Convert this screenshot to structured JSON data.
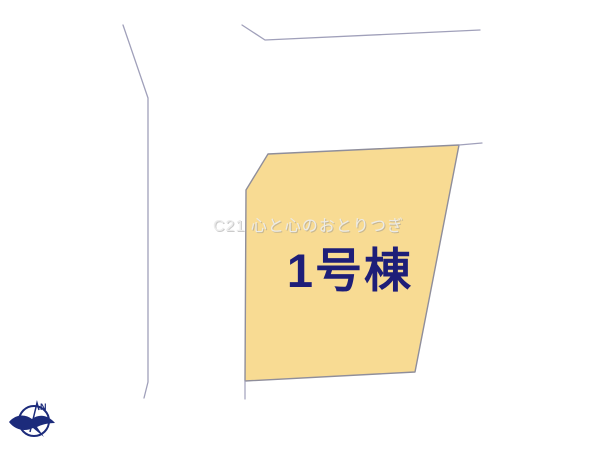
{
  "plan": {
    "parcel": {
      "label": "1号棟"
    },
    "watermark": "C21 心と心のおとりつぎ",
    "compass": {
      "label": "N"
    },
    "colors": {
      "background": "#ffffff",
      "parcel_fill": "#f8db93",
      "parcel_stroke": "#8f8e9b",
      "boundary_line": "#a0a0ba",
      "label_text": "#1e1e78",
      "watermark_text": "#ececec",
      "compass": "#1c2b7b"
    }
  }
}
